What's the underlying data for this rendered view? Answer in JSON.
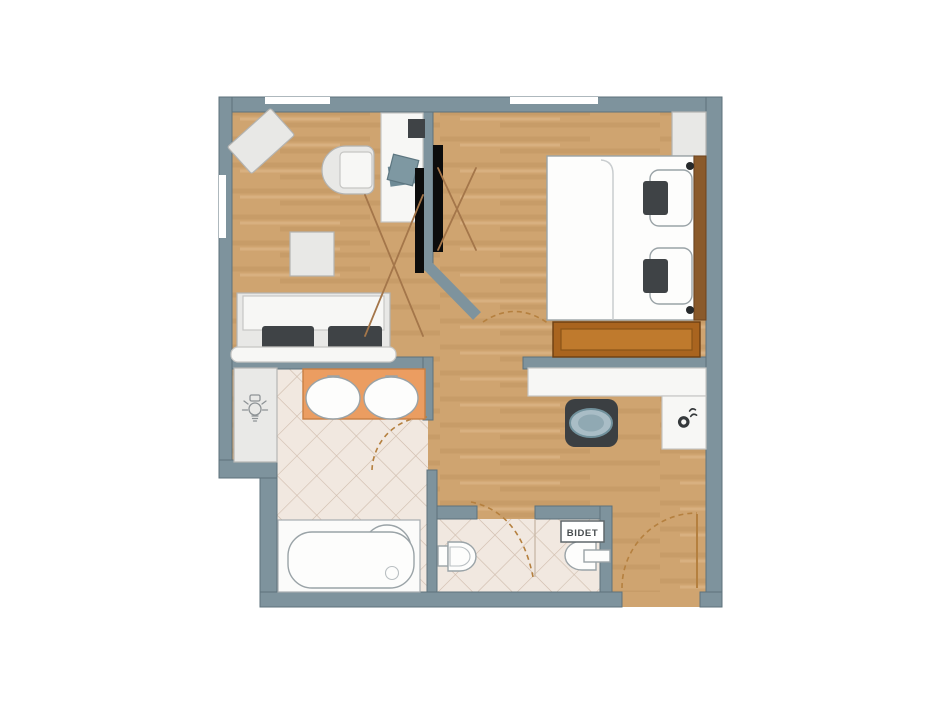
{
  "labels": {
    "bidet": "BIDET"
  },
  "icons": {
    "closet_panel": "lightbulb-icon",
    "entry_counter": "kettle-icon"
  },
  "colors": {
    "canvas": "#ffffff",
    "wall": "#7e939d",
    "wall_outline": "#5d727b",
    "floor_wood": "#cfa470",
    "floor_wood_streak": "#b98f57",
    "tile_bg": "#f1e8e0",
    "tile_line": "#cfbcac",
    "vanity": "#eb9d61",
    "vanity_border": "#c87f44",
    "fixture_stroke": "#9aa3a7",
    "furniture_light": "#e8e8e6",
    "furniture_dark": "#3f4346",
    "bench_wood": "#a9641f",
    "bench_wood_inner": "#bf7a2d",
    "headboard": "#8a5a2b",
    "upholstery_blue": "#7e98a2",
    "stool_cushion": "#a9bdc6",
    "wardrobe_x": "#a4764a",
    "door_arc": "#b5803f"
  }
}
